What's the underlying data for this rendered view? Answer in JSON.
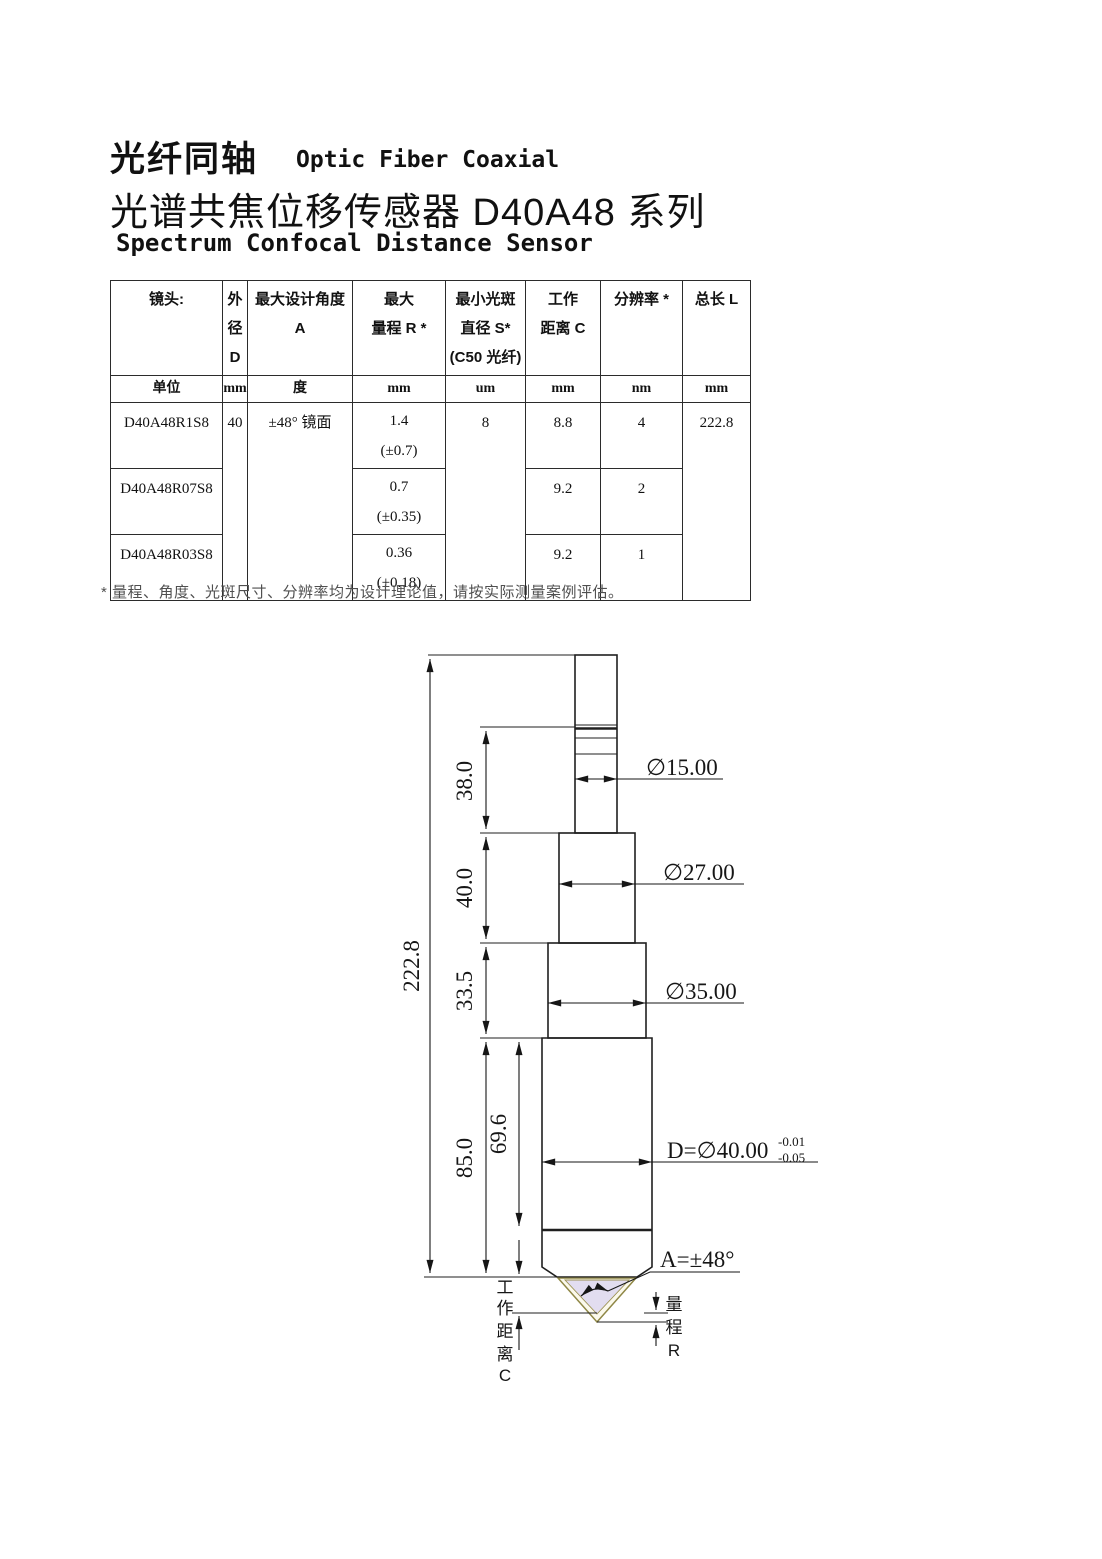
{
  "titles": {
    "cn1": "光纤同轴",
    "en1": "Optic Fiber Coaxial",
    "cn2": "光谱共焦位移传感器 D40A48 系列",
    "en2": "Spectrum Confocal Distance Sensor"
  },
  "table": {
    "headers": [
      "镜头:",
      "外\n径\nD",
      "最大设计角度 A",
      "最大\n量程 R *",
      "最小光斑\n直径 S*\n(C50 光纤)",
      "工作\n距离 C",
      "分辨率 *",
      "总长 L"
    ],
    "units": [
      "单位",
      "mm",
      "度",
      "mm",
      "um",
      "mm",
      "nm",
      "mm"
    ],
    "rows": [
      {
        "model": "D40A48R1S8",
        "od": "40",
        "angle": "±48° 镜面",
        "range": "1.4\n(±0.7)",
        "spot": "8",
        "wd": "8.8",
        "res": "4",
        "length": "222.8"
      },
      {
        "model": "D40A48R07S8",
        "range": "0.7\n(±0.35)",
        "wd": "9.2",
        "res": "2"
      },
      {
        "model": "D40A48R03S8",
        "range": "0.36\n(±0.18)",
        "wd": "9.2",
        "res": "1"
      }
    ]
  },
  "footnote": "* 量程、角度、光斑尺寸、分辨率均为设计理论值，请按实际测量案例评估。",
  "drawing": {
    "total_length": "222.8",
    "len_fiber": "38.0",
    "len_sec2": "40.0",
    "len_sec3": "33.5",
    "len_body": "85.0",
    "len_lens": "69.6",
    "dia_fiber": "∅15.00",
    "dia_sec2": "∅27.00",
    "dia_sec3": "∅35.00",
    "dia_body": "D=∅40.00",
    "dia_body_tol_up": "-0.01",
    "dia_body_tol_low": "-0.05",
    "angle": "A=±48°",
    "wd_chars": [
      "工",
      "作",
      "距",
      "离",
      "C"
    ],
    "range_chars": [
      "量",
      "程",
      "R"
    ]
  }
}
